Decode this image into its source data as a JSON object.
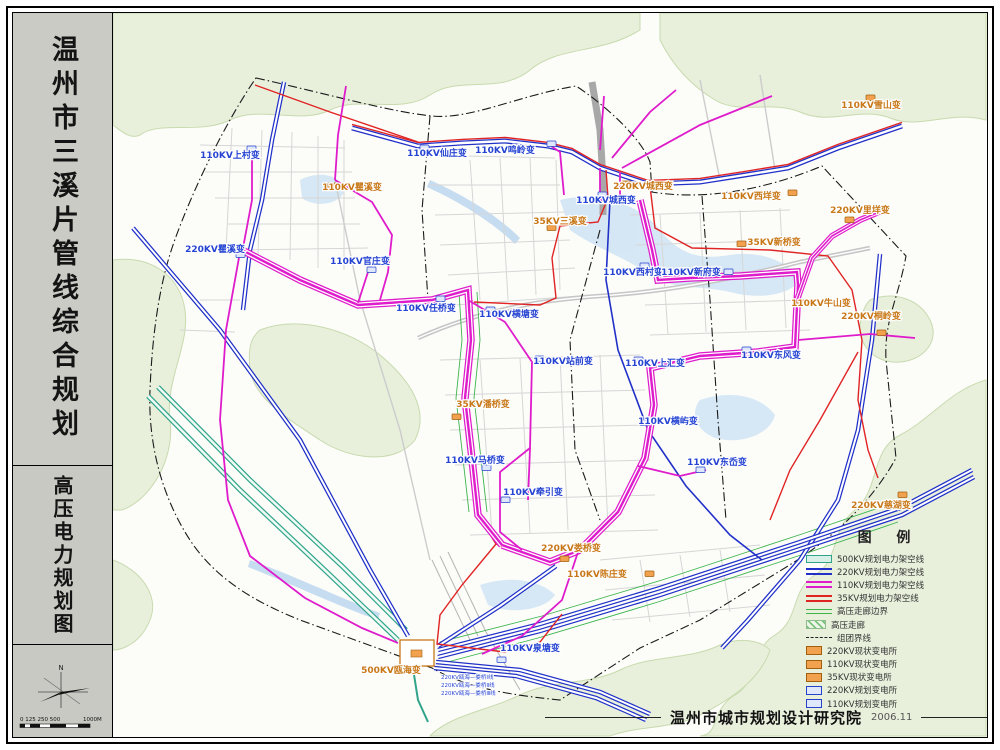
{
  "sidebar": {
    "title": "温州市三溪片管线综合规划",
    "subtitle": "高压电力规划图",
    "compass_label": "N",
    "scale_ticks": "0 125 250 500",
    "scale_end": "1000M"
  },
  "legend": {
    "title": "图 例",
    "items": [
      "500KV规划电力架空线",
      "220KV规划电力架空线",
      "110KV规划电力架空线",
      "35KV规划电力架空线",
      "高压走廊边界",
      "高压走廊",
      "组团界线",
      "220KV现状变电所",
      "110KV现状变电所",
      "35KV现状变电所",
      "220KV规划变电所",
      "110KV规划变电所"
    ]
  },
  "footer": {
    "institute": "温州市城市规划设计研究院",
    "date": "2006.11"
  },
  "map": {
    "stations": [
      "110KV上村变",
      "110KV瞿溪变",
      "110KV仙庄变",
      "110KV鸣岭变",
      "220KV瞿溪变",
      "110KV官庄变",
      "110KV任桥变",
      "110KV横塘变",
      "35KV三溪变",
      "110KV城西变",
      "220KV城西变",
      "110KV雪山变",
      "110KV西垟变",
      "220KV里垟变",
      "35KV新桥变",
      "110KV西村变",
      "110KV新府变",
      "110KV牛山变",
      "220KV桐岭变",
      "110KV站前变",
      "110KV上汇变",
      "110KV东风变",
      "35KV潘桥变",
      "110KV横屿变",
      "110KV马桥变",
      "110KV东岙变",
      "110KV牵引变",
      "220KV娄桥变",
      "110KV陈庄变",
      "220KV慈湖变",
      "110KV泉塘变",
      "500KV瓯海变"
    ],
    "line_labels": [
      "220KV瓯海—娄桥Ⅰ线",
      "220KV瓯海—娄桥Ⅱ线",
      "220KV瓯海—娄桥Ⅲ线"
    ]
  },
  "colors": {
    "kv500": "#2fa489",
    "kv220": "#2131c8",
    "kv110": "#df1ccb",
    "kv35": "#e02424",
    "corridor_edge": "#3db54d",
    "existing_station": "#f2a24e",
    "planned_station": "#dfe7fb"
  }
}
